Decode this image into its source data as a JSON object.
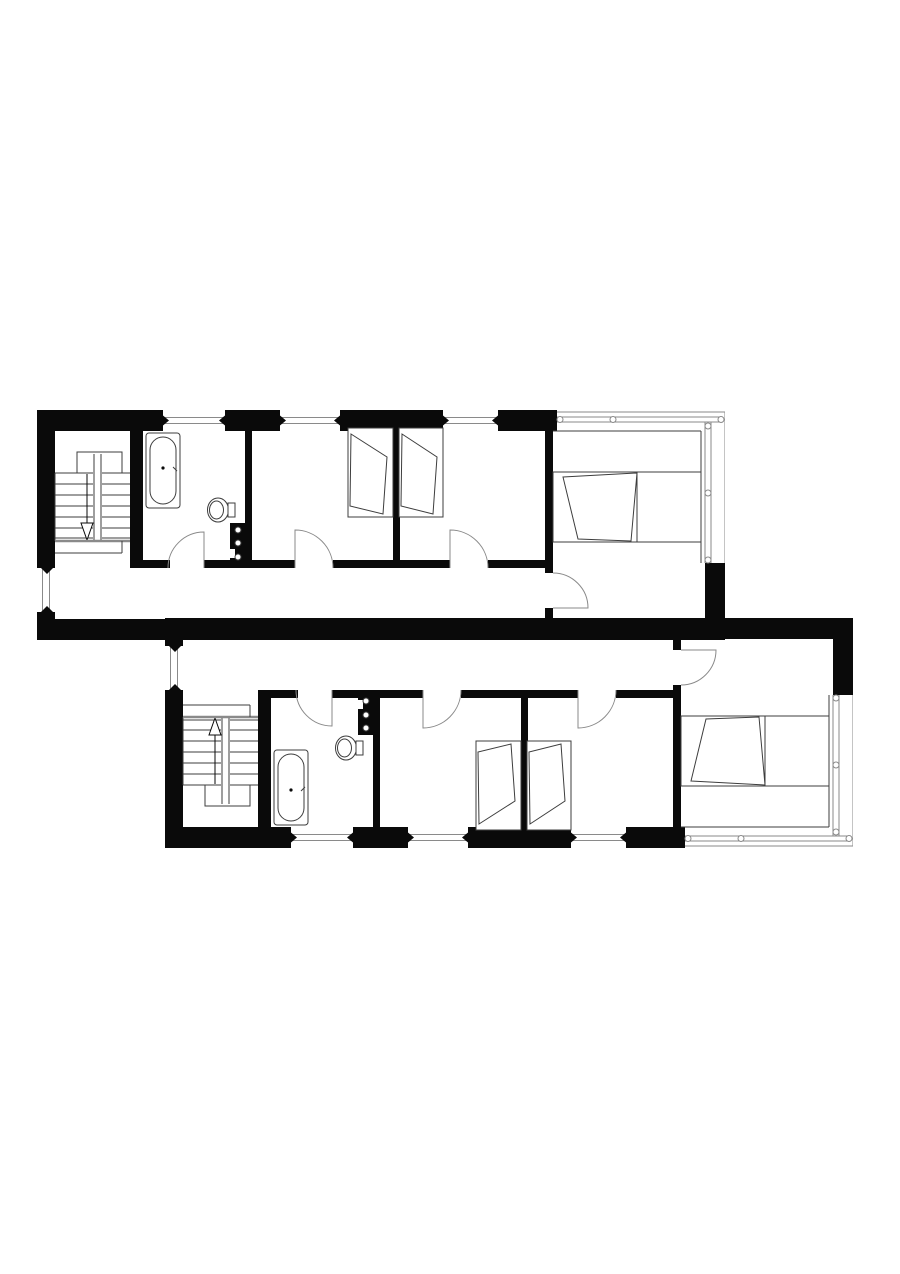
{
  "page": {
    "background": "#ffffff",
    "width": 900,
    "height": 1274
  },
  "colors": {
    "wall": "#0a0a0a",
    "thin": "#3d3d3d",
    "glaze": "#8a8a8a",
    "arc": "#8a8a8a",
    "white": "#ffffff"
  },
  "units": [
    {
      "id": "upper-unit-floor-plan",
      "left": 37,
      "top": 410,
      "flipped": false
    },
    {
      "id": "lower-unit-floor-plan",
      "left": 165,
      "top": 618,
      "flipped": true
    }
  ],
  "unit_template": {
    "width": 688,
    "height": 230,
    "elements": [
      {
        "name": "top-wall-segment-1",
        "type": "wall",
        "x": 0,
        "y": 0,
        "w": 126,
        "h": 21
      },
      {
        "name": "top-wall-segment-2",
        "type": "wall",
        "x": 188,
        "y": 0,
        "w": 55,
        "h": 21
      },
      {
        "name": "top-wall-segment-3",
        "type": "wall",
        "x": 303,
        "y": 0,
        "w": 103,
        "h": 21
      },
      {
        "name": "top-wall-segment-4",
        "type": "wall",
        "x": 461,
        "y": 0,
        "w": 59,
        "h": 21
      },
      {
        "name": "left-exterior-wall",
        "type": "wall",
        "x": 0,
        "y": 0,
        "w": 18,
        "h": 158
      },
      {
        "name": "left-exterior-wall-end",
        "type": "wall",
        "x": 0,
        "y": 202,
        "w": 18,
        "h": 28
      },
      {
        "name": "party-wall-band",
        "type": "wall",
        "x": 0,
        "y": 209,
        "w": 688,
        "h": 21
      },
      {
        "name": "right-exterior-wall-piece",
        "type": "wall",
        "x": 668,
        "y": 153,
        "w": 20,
        "h": 77
      },
      {
        "name": "wall-stair-bathroom",
        "type": "wall",
        "x": 93,
        "y": 21,
        "w": 13,
        "h": 137
      },
      {
        "name": "wall-bathroom-bedroom1",
        "type": "wall",
        "x": 208,
        "y": 21,
        "w": 7,
        "h": 137
      },
      {
        "name": "wall-bedroom1-bedroom2",
        "type": "wall",
        "x": 356,
        "y": 21,
        "w": 7,
        "h": 137
      },
      {
        "name": "wall-bedroom2-master",
        "type": "wall",
        "x": 508,
        "y": 21,
        "w": 8,
        "h": 142
      },
      {
        "name": "master-door-jamb",
        "type": "wall",
        "x": 508,
        "y": 198,
        "w": 8,
        "h": 11
      },
      {
        "name": "corridor-wall-seg-1",
        "type": "wall",
        "x": 93,
        "y": 150,
        "w": 40,
        "h": 8
      },
      {
        "name": "corridor-wall-seg-2",
        "type": "wall",
        "x": 167,
        "y": 150,
        "w": 41,
        "h": 8
      },
      {
        "name": "corridor-wall-seg-3",
        "type": "wall",
        "x": 215,
        "y": 150,
        "w": 43,
        "h": 8
      },
      {
        "name": "corridor-wall-seg-4",
        "type": "wall",
        "x": 296,
        "y": 150,
        "w": 60,
        "h": 8
      },
      {
        "name": "corridor-wall-seg-5",
        "type": "wall",
        "x": 363,
        "y": 150,
        "w": 50,
        "h": 8
      },
      {
        "name": "corridor-wall-seg-6",
        "type": "wall",
        "x": 451,
        "y": 150,
        "w": 57,
        "h": 8
      },
      {
        "name": "plumbing-shaft",
        "type": "wall",
        "x": 193,
        "y": 113,
        "w": 20,
        "h": 45
      },
      {
        "name": "shaft-notch",
        "type": "wrect",
        "x": 193,
        "y": 139,
        "w": 5,
        "h": 9
      },
      {
        "name": "shaft-fitting-1",
        "type": "circle",
        "cx": 201,
        "cy": 120,
        "r": 3
      },
      {
        "name": "shaft-fitting-2",
        "type": "circle",
        "cx": 201,
        "cy": 133,
        "r": 3
      },
      {
        "name": "shaft-fitting-3",
        "type": "circle",
        "cx": 201,
        "cy": 147,
        "r": 3
      },
      {
        "name": "window-top-1",
        "type": "win-h",
        "x": 126,
        "w": 62
      },
      {
        "name": "window-top-2",
        "type": "win-h",
        "x": 243,
        "w": 60
      },
      {
        "name": "window-top-3",
        "type": "win-h",
        "x": 406,
        "w": 55
      },
      {
        "name": "window-left",
        "type": "win-v",
        "y": 158,
        "h": 44
      },
      {
        "name": "curtain-outer-top",
        "type": "line",
        "x1": 520,
        "y1": 2,
        "x2": 688,
        "y2": 2,
        "c": "glaze"
      },
      {
        "name": "curtain-outer-right",
        "type": "line",
        "x1": 688,
        "y1": 2,
        "x2": 688,
        "y2": 153,
        "c": "glaze"
      },
      {
        "name": "curtain-glass-top-a",
        "type": "line",
        "x1": 520,
        "y1": 7,
        "x2": 686,
        "y2": 7,
        "c": "glaze"
      },
      {
        "name": "curtain-glass-top-b",
        "type": "line",
        "x1": 520,
        "y1": 12,
        "x2": 686,
        "y2": 12,
        "c": "glaze"
      },
      {
        "name": "curtain-glass-right-a",
        "type": "line",
        "x1": 668,
        "y1": 12,
        "x2": 668,
        "y2": 153,
        "c": "glaze"
      },
      {
        "name": "curtain-glass-right-b",
        "type": "line",
        "x1": 674,
        "y1": 12,
        "x2": 674,
        "y2": 153,
        "c": "glaze"
      },
      {
        "name": "master-room-inner-top",
        "type": "line",
        "x1": 516,
        "y1": 21,
        "x2": 664,
        "y2": 21,
        "c": "thin"
      },
      {
        "name": "master-room-inner-right",
        "type": "line",
        "x1": 664,
        "y1": 21,
        "x2": 664,
        "y2": 153,
        "c": "thin"
      },
      {
        "name": "mullion-circle-1",
        "type": "circle",
        "cx": 523,
        "cy": 9.5,
        "r": 3,
        "c": "glaze"
      },
      {
        "name": "mullion-circle-2",
        "type": "circle",
        "cx": 576,
        "cy": 9.5,
        "r": 3,
        "c": "glaze"
      },
      {
        "name": "mullion-circle-3",
        "type": "circle",
        "cx": 684,
        "cy": 9.5,
        "r": 3,
        "c": "glaze"
      },
      {
        "name": "mullion-circle-4",
        "type": "circle",
        "cx": 671,
        "cy": 16,
        "r": 3,
        "c": "glaze"
      },
      {
        "name": "mullion-circle-5",
        "type": "circle",
        "cx": 671,
        "cy": 83,
        "r": 3,
        "c": "glaze"
      },
      {
        "name": "mullion-circle-6",
        "type": "circle",
        "cx": 671,
        "cy": 150,
        "r": 3,
        "c": "glaze"
      },
      {
        "name": "door-swing-bathroom",
        "type": "path",
        "d": "M167,158 L167,122 A36 36 0 0 0 131,158",
        "c": "arc"
      },
      {
        "name": "door-swing-bedroom1",
        "type": "path",
        "d": "M258,158 L258,120 A38 38 0 0 1 296,158",
        "c": "arc"
      },
      {
        "name": "door-swing-bedroom2",
        "type": "path",
        "d": "M413,158 L413,120 A38 38 0 0 1 451,158",
        "c": "arc"
      },
      {
        "name": "door-swing-master",
        "type": "path",
        "d": "M516,198 L551,198 A35 35 0 0 0 516,163",
        "c": "arc"
      },
      {
        "name": "stair-landing-outline",
        "type": "rect",
        "x": 40,
        "y": 42,
        "w": 45,
        "h": 21
      },
      {
        "name": "stair-tread-1",
        "type": "line",
        "x1": 18,
        "y1": 63,
        "x2": 93,
        "y2": 63,
        "c": "thin"
      },
      {
        "name": "stair-tread-2",
        "type": "line",
        "x1": 18,
        "y1": 74,
        "x2": 93,
        "y2": 74,
        "c": "thin"
      },
      {
        "name": "stair-tread-3",
        "type": "line",
        "x1": 18,
        "y1": 85,
        "x2": 93,
        "y2": 85,
        "c": "thin"
      },
      {
        "name": "stair-tread-4",
        "type": "line",
        "x1": 18,
        "y1": 96,
        "x2": 93,
        "y2": 96,
        "c": "thin"
      },
      {
        "name": "stair-tread-5",
        "type": "line",
        "x1": 18,
        "y1": 107,
        "x2": 93,
        "y2": 107,
        "c": "thin"
      },
      {
        "name": "stair-tread-6",
        "type": "line",
        "x1": 18,
        "y1": 118,
        "x2": 93,
        "y2": 118,
        "c": "thin"
      },
      {
        "name": "stair-tread-7",
        "type": "line",
        "x1": 18,
        "y1": 128,
        "x2": 93,
        "y2": 128,
        "c": "thin"
      },
      {
        "name": "stair-side-left",
        "type": "line",
        "x1": 18,
        "y1": 63,
        "x2": 18,
        "y2": 131,
        "c": "thin"
      },
      {
        "name": "stair-stringer-gap",
        "type": "wrect",
        "x": 56,
        "y": 44,
        "w": 9,
        "h": 87
      },
      {
        "name": "stair-stringer-left",
        "type": "line",
        "x1": 57,
        "y1": 44,
        "x2": 57,
        "y2": 131,
        "c": "thin"
      },
      {
        "name": "stair-stringer-right",
        "type": "line",
        "x1": 64,
        "y1": 44,
        "x2": 64,
        "y2": 131,
        "c": "thin"
      },
      {
        "name": "stair-direction-stem",
        "type": "line",
        "x1": 50,
        "y1": 64,
        "x2": 50,
        "y2": 116,
        "c": "wall"
      },
      {
        "name": "stair-direction-arrowhead",
        "type": "poly",
        "pts": "44,113 56,113 50,130",
        "fill": "#ffffff",
        "c": "wall"
      },
      {
        "name": "stair-landing-edge",
        "type": "line",
        "x1": 18,
        "y1": 131,
        "x2": 93,
        "y2": 131,
        "c": "glaze",
        "sw": 2.5
      },
      {
        "name": "stair-lower-landing-v",
        "type": "line",
        "x1": 85,
        "y1": 131,
        "x2": 85,
        "y2": 143,
        "c": "thin"
      },
      {
        "name": "stair-lower-landing-h",
        "type": "line",
        "x1": 18,
        "y1": 143,
        "x2": 85,
        "y2": 143,
        "c": "thin"
      },
      {
        "name": "bathtub-outer",
        "type": "rect",
        "x": 109,
        "y": 23,
        "w": 34,
        "h": 75,
        "rx": 3
      },
      {
        "name": "bathtub-inner",
        "type": "rect",
        "x": 113,
        "y": 27,
        "w": 26,
        "h": 67,
        "rx": 13
      },
      {
        "name": "bathtub-drain",
        "type": "dot",
        "cx": 126,
        "cy": 58,
        "r": 1.6
      },
      {
        "name": "bathtub-tap",
        "type": "line",
        "x1": 136,
        "y1": 57,
        "x2": 140,
        "y2": 61,
        "c": "thin"
      },
      {
        "name": "toilet-bowl",
        "type": "ellipse",
        "cx": 181,
        "cy": 100,
        "rx": 10.5,
        "ry": 12
      },
      {
        "name": "toilet-seat",
        "type": "ellipse",
        "cx": 179.5,
        "cy": 100,
        "rx": 7,
        "ry": 9
      },
      {
        "name": "toilet-cistern",
        "type": "rect",
        "x": 191,
        "y": 93,
        "w": 7,
        "h": 14
      },
      {
        "name": "single-bed-1-frame",
        "type": "rect",
        "x": 311,
        "y": 18,
        "w": 45,
        "h": 89
      },
      {
        "name": "single-bed-1-duvet",
        "type": "poly",
        "pts": "314,24 350,47 346,104 313,96",
        "fill": "#ffffff",
        "c": "thin"
      },
      {
        "name": "single-bed-2-frame",
        "type": "rect",
        "x": 362,
        "y": 18,
        "w": 44,
        "h": 89
      },
      {
        "name": "single-bed-2-duvet",
        "type": "poly",
        "pts": "365,24 400,47 396,104 364,96",
        "fill": "#ffffff",
        "c": "thin"
      },
      {
        "name": "master-bed-platform-top",
        "type": "line",
        "x1": 516,
        "y1": 62,
        "x2": 664,
        "y2": 62,
        "c": "thin"
      },
      {
        "name": "master-bed-platform-bottom",
        "type": "line",
        "x1": 516,
        "y1": 132,
        "x2": 664,
        "y2": 132,
        "c": "thin"
      },
      {
        "name": "master-bed-frame",
        "type": "rect",
        "x": 516,
        "y": 62,
        "w": 84,
        "h": 70
      },
      {
        "name": "master-bed-duvet",
        "type": "poly",
        "pts": "526,67 600,63 594,131 541,129",
        "fill": "#ffffff",
        "c": "thin"
      }
    ]
  }
}
